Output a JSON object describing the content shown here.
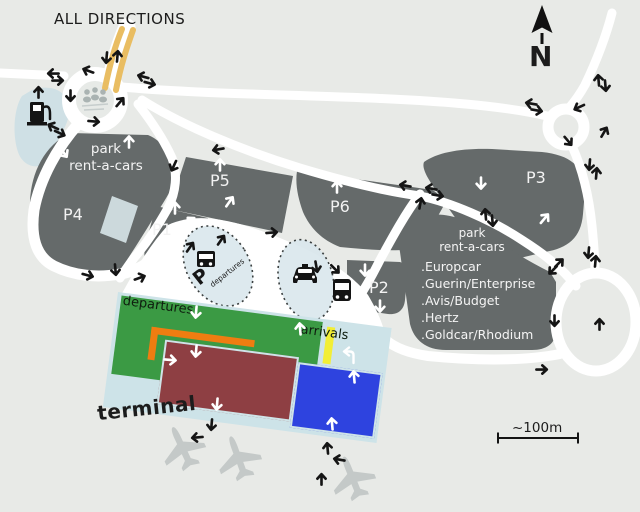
{
  "map_title": "ALL DIRECTIONS",
  "compass": {
    "north_label": "N"
  },
  "scale_bar": {
    "label": "~100m"
  },
  "terminal": {
    "name_label": "terminal",
    "departures_label": "departures",
    "arrivals_label": "arrivals"
  },
  "parking_lots": {
    "p1": "P1",
    "p2": "P2",
    "p3": "P3",
    "p4": "P4",
    "p5": "P5",
    "p6": "P6"
  },
  "rent_a_car": {
    "left_line1": "park",
    "left_line2": "rent-a-cars",
    "right_line1": "park",
    "right_line2": "rent-a-cars"
  },
  "rental_companies": [
    ".Europcar",
    ".Guerin/Enterprise",
    ".Avis/Budget",
    ".Hertz",
    ".Goldcar/Rhodium"
  ],
  "transit_zones": {
    "bus_zone_p": "P",
    "bus_zone_text": "departures"
  },
  "colors": {
    "background": "#e8eae7",
    "road": "#ffffff",
    "parking_lot": "#656a6a",
    "lot_label": "#f2f2f2",
    "terminal_base": "#cde3e8",
    "departures_green": "#3b9a44",
    "building_maroon": "#8e3f43",
    "building_blue": "#2e43df",
    "stripe_yellow": "#f2ee35",
    "curb_orange": "#ef7d11",
    "highway_orange": "#e9bd62",
    "zone_fill": "#d9e7ec",
    "plane_grey": "#c4c9c8",
    "water_blue": "#cfe0e5"
  },
  "arrows": {
    "black": [
      [
        52,
        73,
        270
      ],
      [
        58,
        80,
        90
      ],
      [
        142,
        76,
        285
      ],
      [
        150,
        83,
        105
      ],
      [
        106,
        58,
        185
      ],
      [
        117,
        55,
        5
      ],
      [
        38,
        91,
        0
      ],
      [
        70,
        96,
        180
      ],
      [
        87,
        70,
        290
      ],
      [
        94,
        121,
        95
      ],
      [
        120,
        101,
        40
      ],
      [
        52,
        126,
        295
      ],
      [
        60,
        133,
        115
      ],
      [
        217,
        149,
        260
      ],
      [
        173,
        166,
        205
      ],
      [
        88,
        275,
        105
      ],
      [
        115,
        270,
        175
      ],
      [
        140,
        277,
        70
      ],
      [
        190,
        246,
        35
      ],
      [
        221,
        239,
        35
      ],
      [
        272,
        232,
        85
      ],
      [
        316,
        267,
        170
      ],
      [
        335,
        269,
        135
      ],
      [
        404,
        185,
        280
      ],
      [
        420,
        202,
        10
      ],
      [
        430,
        188,
        280
      ],
      [
        438,
        195,
        100
      ],
      [
        485,
        213,
        355
      ],
      [
        492,
        221,
        175
      ],
      [
        530,
        103,
        280
      ],
      [
        537,
        110,
        100
      ],
      [
        578,
        107,
        245
      ],
      [
        568,
        141,
        140
      ],
      [
        604,
        131,
        30
      ],
      [
        598,
        79,
        355
      ],
      [
        605,
        86,
        175
      ],
      [
        589,
        165,
        185
      ],
      [
        596,
        172,
        5
      ],
      [
        588,
        253,
        185
      ],
      [
        595,
        260,
        5
      ],
      [
        559,
        262,
        45
      ],
      [
        552,
        270,
        225
      ],
      [
        554,
        321,
        180
      ],
      [
        599,
        323,
        0
      ],
      [
        542,
        369,
        90
      ],
      [
        211,
        425,
        185
      ],
      [
        196,
        437,
        265
      ],
      [
        327,
        447,
        355
      ],
      [
        338,
        459,
        280
      ],
      [
        321,
        478,
        0
      ]
    ],
    "white": [
      [
        129,
        141,
        0
      ],
      [
        64,
        153,
        145
      ],
      [
        220,
        164,
        0
      ],
      [
        230,
        201,
        35
      ],
      [
        175,
        207,
        0
      ],
      [
        191,
        221,
        315
      ],
      [
        152,
        255,
        0
      ],
      [
        337,
        186,
        0
      ],
      [
        481,
        184,
        180
      ],
      [
        545,
        218,
        40
      ],
      [
        365,
        271,
        180
      ],
      [
        380,
        307,
        180
      ],
      [
        196,
        313,
        185
      ],
      [
        300,
        328,
        355
      ],
      [
        171,
        360,
        95
      ],
      [
        196,
        352,
        185
      ],
      [
        217,
        405,
        185
      ],
      [
        332,
        423,
        355
      ],
      [
        354,
        376,
        355
      ]
    ]
  }
}
